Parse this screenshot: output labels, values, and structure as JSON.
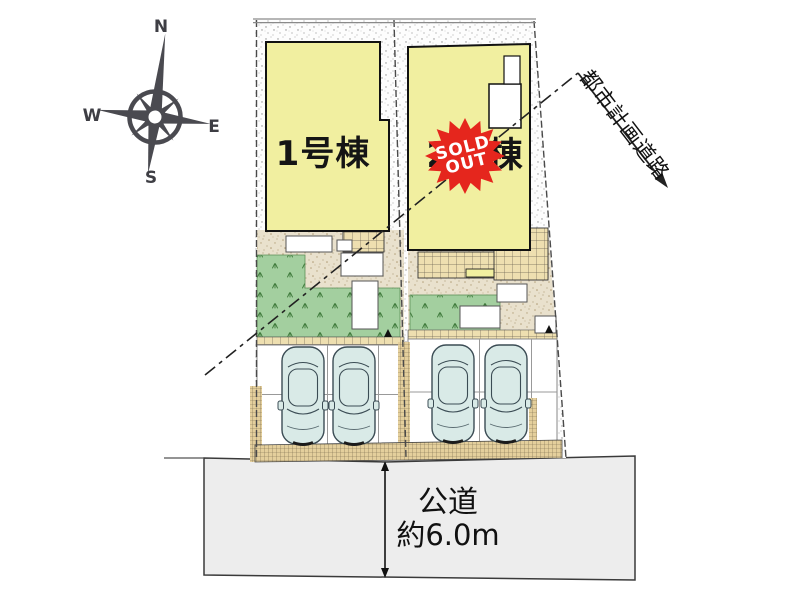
{
  "plan": {
    "building1": {
      "label": "1号棟"
    },
    "building2": {
      "label": "2号棟"
    },
    "sold_out": {
      "line1": "SOLD",
      "line2": "OUT"
    },
    "road": {
      "name": "公道",
      "width": "約6.0m"
    },
    "planning_road": {
      "label": "都市計画道路"
    },
    "compass": {
      "north": "N",
      "south": "S",
      "east": "E",
      "west": "W"
    },
    "counts": {
      "cars": 4,
      "lots": 2
    },
    "colors": {
      "building_fill": "#f1efa0",
      "badge_red": "#e5261d",
      "grass_green": "#a3cf9f",
      "tile_tan": "#eedfb0",
      "yard_sand": "#e9e1cd",
      "curb_hatch": "#e4cf9c",
      "road_gray": "#ededed",
      "car_body": "#d9eae7",
      "compass_gray": "#4a4a50",
      "line_black": "#1a1a1a"
    }
  }
}
